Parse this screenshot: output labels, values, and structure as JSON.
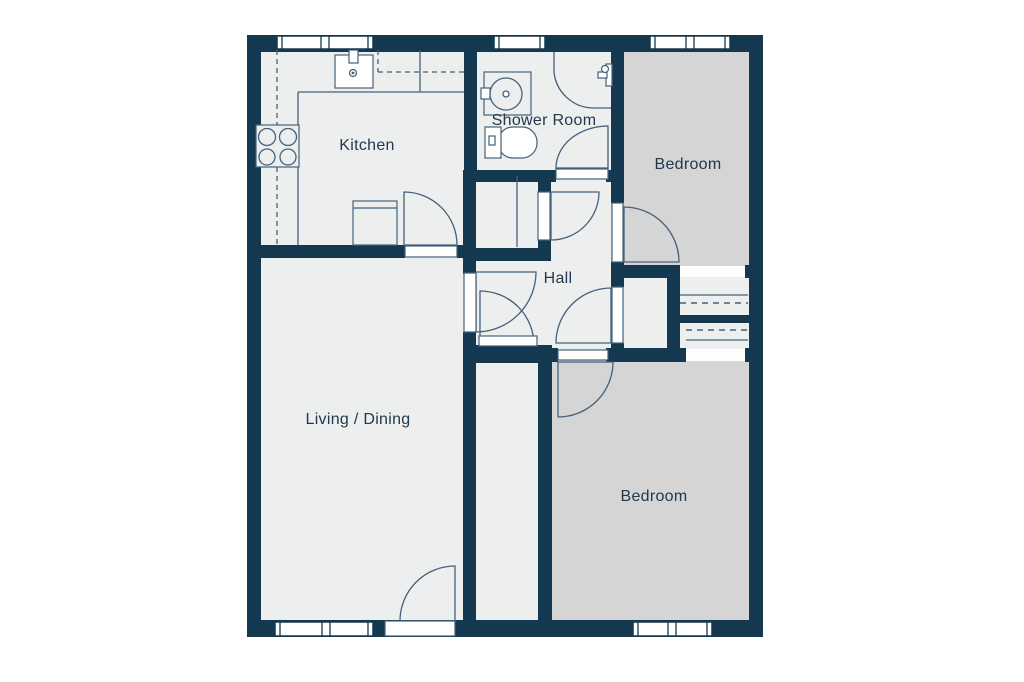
{
  "title": "Apartment floor plan",
  "rooms": [
    {
      "id": "kitchen",
      "label": "Kitchen"
    },
    {
      "id": "shower_room",
      "label": "Shower Room"
    },
    {
      "id": "bedroom_top",
      "label": "Bedroom"
    },
    {
      "id": "hall",
      "label": "Hall"
    },
    {
      "id": "living_dining",
      "label": "Living / Dining"
    },
    {
      "id": "bedroom_bottom",
      "label": "Bedroom"
    }
  ],
  "fixtures": [
    "hob-4-burner",
    "kitchen-sink",
    "kitchen-counter",
    "wall-cabinets-dashed",
    "appliance-unit",
    "wash-basin",
    "toilet",
    "shower-enclosure",
    "shower-valve",
    "built-in-wardrobe-top",
    "built-in-wardrobe-bottom",
    "hall-cupboard",
    "store-cupboard"
  ],
  "windows_count": 5,
  "doors_count": 9,
  "colors": {
    "wall": "#14384f",
    "room_light": "#edefee",
    "room_gray": "#d4d5d4",
    "line": "#44617c",
    "text": "#22384e",
    "background": "#ffffff"
  }
}
